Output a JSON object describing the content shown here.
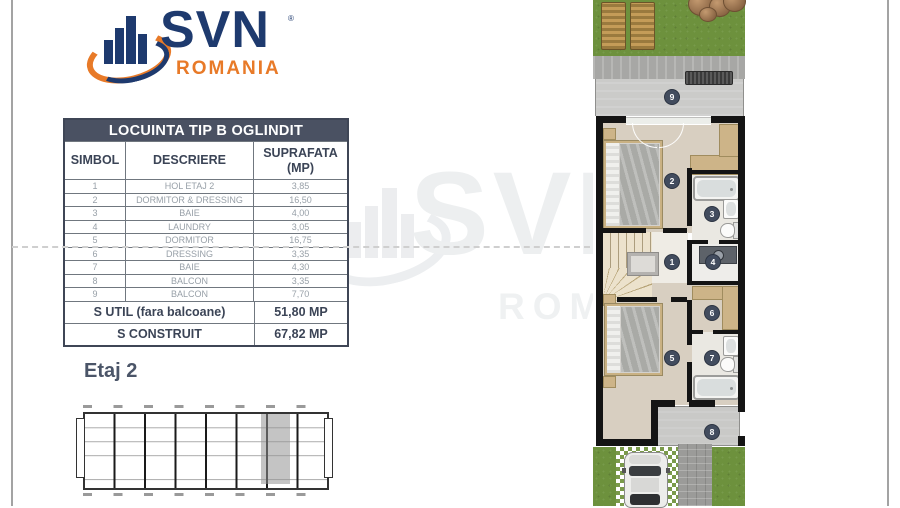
{
  "logo": {
    "brand": "SVN",
    "registered": "®",
    "region": "ROMANIA"
  },
  "watermark": {
    "brand": "SVN",
    "region": "ROMANIA"
  },
  "table": {
    "title": "LOCUINTA TIP B OGLINDIT",
    "header": {
      "simbol": "SIMBOL",
      "descriere": "DESCRIERE",
      "suprafata_1": "SUPRAFATA",
      "suprafata_2": "(MP)"
    },
    "rows": [
      {
        "n": "1",
        "desc": "HOL ETAJ 2",
        "area": "3,85"
      },
      {
        "n": "2",
        "desc": "DORMITOR & DRESSING",
        "area": "16,50"
      },
      {
        "n": "3",
        "desc": "BAIE",
        "area": "4,00"
      },
      {
        "n": "4",
        "desc": "LAUNDRY",
        "area": "3,05"
      },
      {
        "n": "5",
        "desc": "DORMITOR",
        "area": "16,75"
      },
      {
        "n": "6",
        "desc": "DRESSING",
        "area": "3,35"
      },
      {
        "n": "7",
        "desc": "BAIE",
        "area": "4,30"
      },
      {
        "n": "8",
        "desc": "BALCON",
        "area": "3,35"
      },
      {
        "n": "9",
        "desc": "BALCON",
        "area": "7,70"
      }
    ],
    "summary": [
      {
        "label": "S UTIL (fara balcoane)",
        "value": "51,80 MP"
      },
      {
        "label": "S CONSTRUIT",
        "value": "67,82 MP"
      }
    ]
  },
  "floor_label": "Etaj 2",
  "plan": {
    "markers": [
      "1",
      "2",
      "3",
      "4",
      "5",
      "6",
      "7",
      "8",
      "9"
    ]
  },
  "colors": {
    "navy": "#1e3a6e",
    "orange": "#e87a28",
    "table_header_bg": "#4a5162",
    "marker_bg": "#424c5e",
    "grass": "#6d913d",
    "wall": "#141414"
  }
}
